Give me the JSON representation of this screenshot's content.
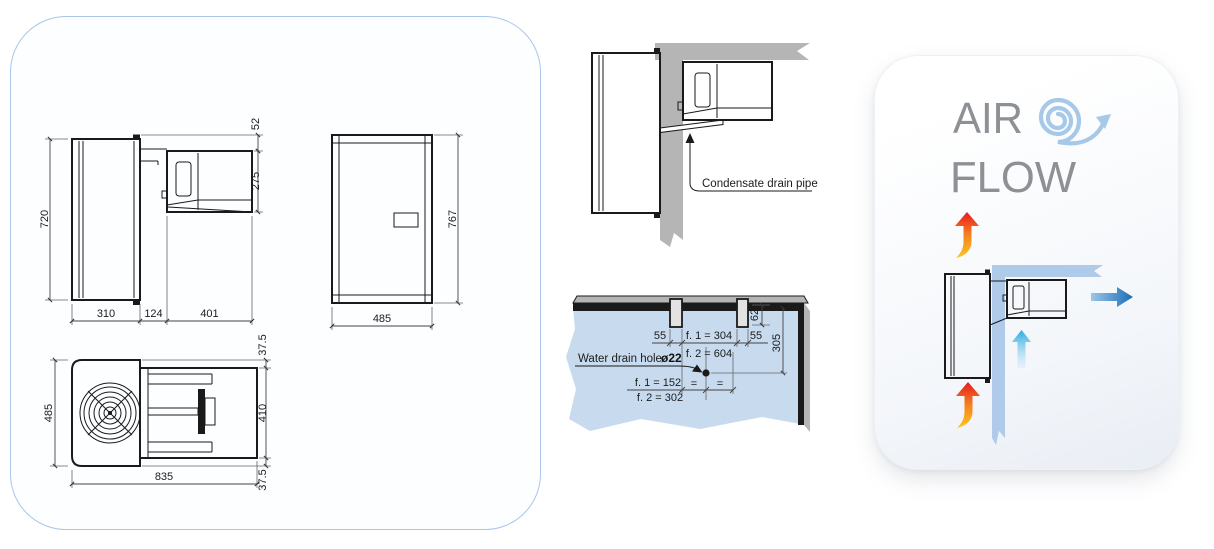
{
  "side_view": {
    "overall_height": "720",
    "condenser_top_offset": "52",
    "condenser_height": "275",
    "interior_depth": "310",
    "wall_thickness": "124",
    "exterior_depth": "401"
  },
  "front_view": {
    "width": "485",
    "height": "767"
  },
  "top_view": {
    "depth": "485",
    "top_margin": "37.5",
    "condenser_width": "410",
    "bottom_margin": "37.5",
    "overall_length": "835"
  },
  "condensate": {
    "label": "Condensate drain pipe"
  },
  "cutout": {
    "slot_width_left": "55",
    "between_slots_f1": "f. 1 = 304",
    "between_slots_f2": "f. 2 = 604",
    "slot_width_right": "55",
    "slot_depth": "62",
    "hole_distance_from_top": "305",
    "hole_label": "Water drain hole",
    "hole_diameter": "ø22",
    "hole_offset_f1": "f. 1 = 152",
    "hole_offset_f2": "f. 2 = 302",
    "equal_left": "=",
    "equal_right": "="
  },
  "airflow": {
    "title_line1": "AIR",
    "title_line2": "FLOW"
  },
  "colors": {
    "panel_border": "#a9c6ea",
    "line_black": "#1a1a1a",
    "wall_gray": "#b5b5b5",
    "cutout_wall_blue": "#c7daee",
    "airflow_wall_blue": "#afcbe9",
    "spiral_blue": "#a6c8e9",
    "hot_red": "#e8191f",
    "hot_orange": "#f5821f",
    "hot_yellow": "#fdc51d",
    "cold_blue": "#29abe2",
    "out_dark_blue": "#1a6db5",
    "title_gray": "#8d9195"
  }
}
